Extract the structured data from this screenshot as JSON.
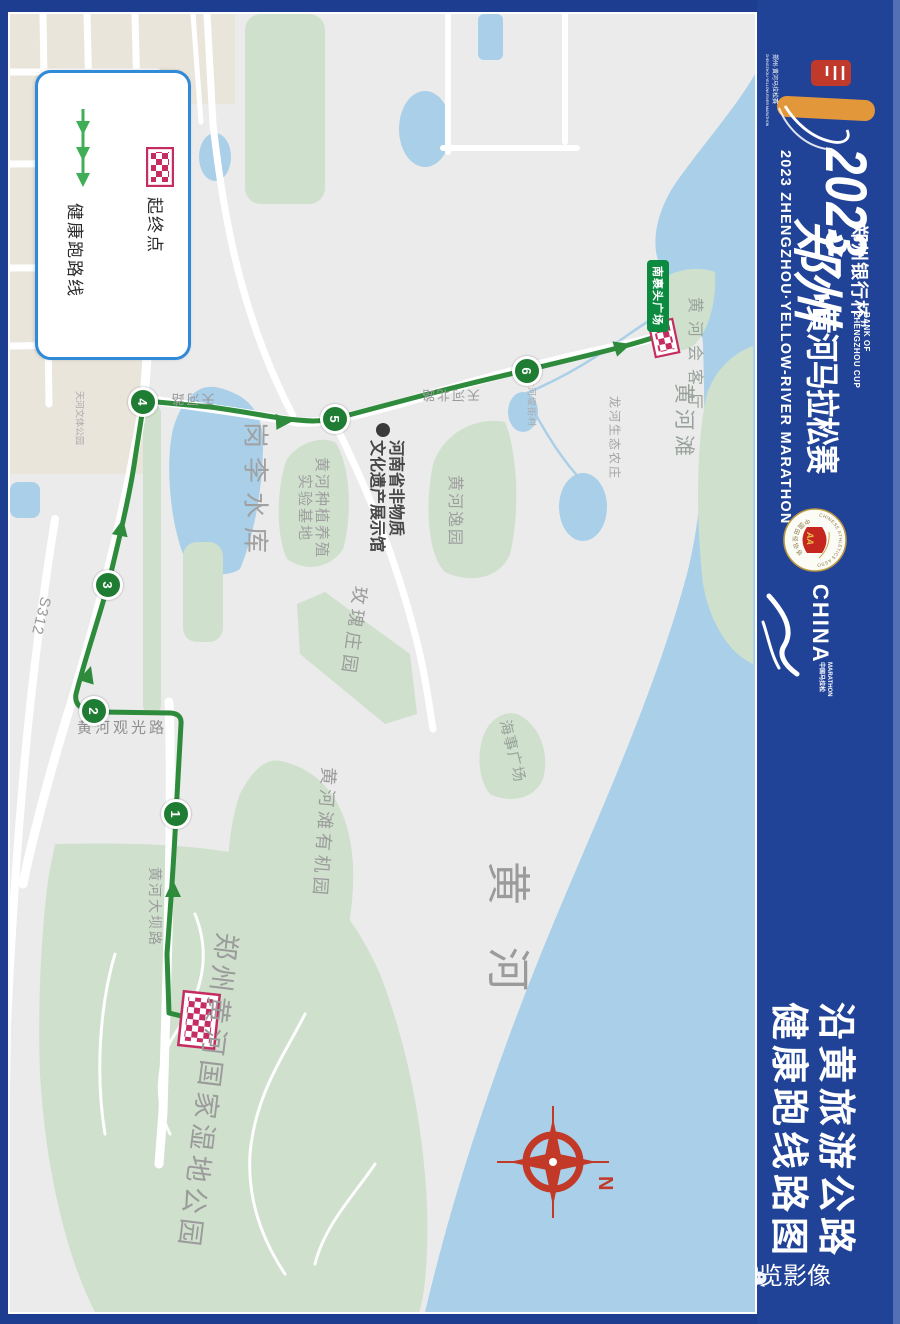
{
  "colors": {
    "frame_blue": "#1d3e90",
    "sidebar_blue": "#214397",
    "edge_strip": "#5470b5",
    "map_background": "#ebebeb",
    "water": "#a9cfe9",
    "park_green": "#cfe0cd",
    "built_area": "#e9e5db",
    "route_green": "#2e8b3c",
    "checkpoint_green": "#1e7c33",
    "flag_crimson": "#c52d62",
    "legend_border": "#2f8ad8",
    "compass_red": "#c23a27",
    "badge_green": "#0c8a40",
    "label_gray": "#9b9b9b"
  },
  "sidebar": {
    "year": "2023",
    "cup_cn": "“郑州银行杯”",
    "cup_en1": "BANK OF",
    "cup_en2": "ZHENGZHOU CUP",
    "title_script": "郑州",
    "title_rest": "·黄河马拉松赛",
    "title_en": "2023 ZHENGZHOU·YELLOW-RIVER MARATHON",
    "caa_arc_top": "CHINESE ATHLETICS ASSOCIATION",
    "caa_arc_bottom": "中国田径协会",
    "caa_flag": "AA",
    "china": "CHINA",
    "china_sub1": "MARATHON",
    "china_sub2": "中国马拉松",
    "logo_micro1": "郑州·黄河马拉松赛",
    "logo_micro2": "ZHENGZHOU·YELLOW-RIVER MARATHON",
    "big_title_line1": "沿黄旅游公路",
    "big_title_line2": "健康跑线路图",
    "watermark": "豫览影像"
  },
  "legend": {
    "start_end_label": "起终点",
    "route_label": "健康跑路线"
  },
  "map": {
    "compass_n": "N",
    "checkpoints": [
      {
        "n": "1"
      },
      {
        "n": "2"
      },
      {
        "n": "3"
      },
      {
        "n": "4"
      },
      {
        "n": "5"
      },
      {
        "n": "6"
      }
    ],
    "labels": [
      {
        "text": "南裹头广场"
      },
      {
        "text": "黄河会客厅"
      },
      {
        "text": "黄河滩"
      },
      {
        "text": "龙河生态农庄"
      },
      {
        "text": "大河堤街村"
      },
      {
        "text": "天河北路"
      },
      {
        "text": "黄河"
      },
      {
        "text": "岗李水库"
      },
      {
        "text": "河南省非物质"
      },
      {
        "text": "文化遗产展示馆"
      },
      {
        "text": "黄河种植养殖"
      },
      {
        "text": "实验基地"
      },
      {
        "text": "黄河逸园"
      },
      {
        "text": "玫瑰庄园"
      },
      {
        "text": "黄河观光路"
      },
      {
        "text": "S312"
      },
      {
        "text": "黄河滩有机园"
      },
      {
        "text": "黄河大坝路"
      },
      {
        "text": "郑州黄河国家湿地公园"
      },
      {
        "text": "海事广场"
      },
      {
        "text": "天河路"
      },
      {
        "text": "天河文体公园"
      }
    ]
  }
}
